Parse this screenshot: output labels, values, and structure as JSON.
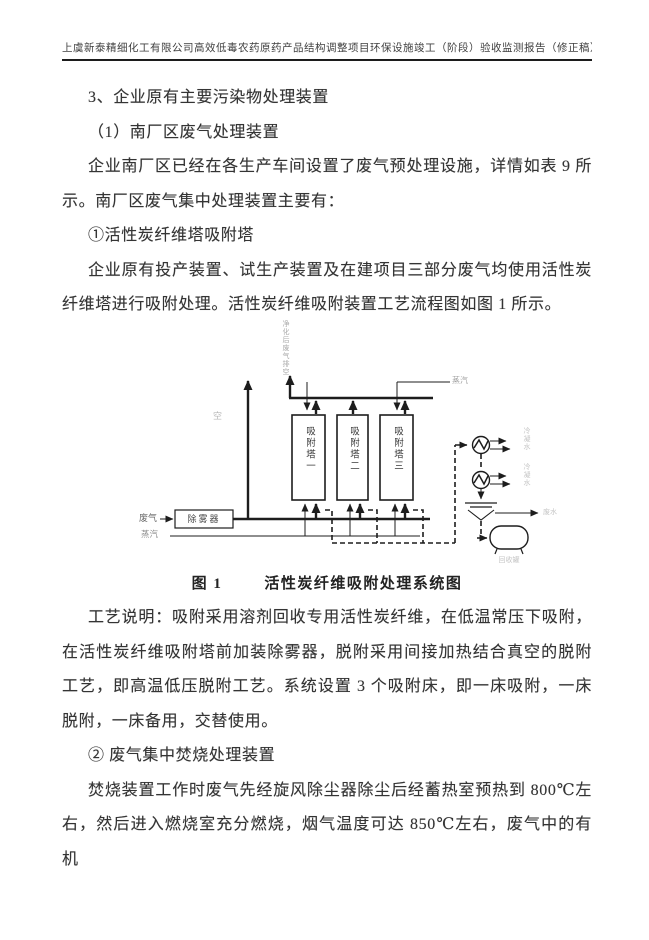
{
  "header": {
    "title": "上虞新泰精细化工有限公司高效低毒农药原药产品结构调整项目环保设施竣工（阶段）验收监测报告（修正稿）"
  },
  "body": {
    "p1": "3、企业原有主要污染物处理装置",
    "p2": "（1）南厂区废气处理装置",
    "p3": "企业南厂区已经在各生产车间设置了废气预处理设施，详情如表 9 所示。南厂区废气集中处理装置主要有：",
    "p4": "①活性炭纤维塔吸附塔",
    "p5": "企业原有投产装置、试生产装置及在建项目三部分废气均使用活性炭纤维塔进行吸附处理。活性炭纤维吸附装置工艺流程图如图 1 所示。",
    "p6": "工艺说明：吸附采用溶剂回收专用活性炭纤维，在低温常压下吸附，在活性炭纤维吸附塔前加装除雾器，脱附采用间接加热结合真空的脱附工艺，即高温低压脱附工艺。系统设置 3 个吸附床，即一床吸附，一床脱附，一床备用，交替使用。",
    "p7": "② 废气集中焚烧处理装置",
    "p8": "焚烧装置工作时废气先经旋风除尘器除尘后经蓄热室预热到 800℃左右，然后进入燃烧室充分燃烧，烟气温度可达 850℃左右，废气中的有机"
  },
  "figure": {
    "caption_label": "图 1",
    "caption_title": "活性炭纤维吸附处理系统图",
    "labels": {
      "stack": "净化后废气排空",
      "vent": "空",
      "steam_top": "蒸汽",
      "inlet_gas": "废气",
      "steam_bottom": "蒸汽",
      "demister": "除雾器",
      "tower1": "吸附塔一",
      "tower2": "吸附塔二",
      "tower3": "吸附塔三",
      "condensate1": "冷凝水",
      "condensate2": "冷凝水",
      "wastewater": "废水",
      "tank": "回收罐"
    }
  }
}
